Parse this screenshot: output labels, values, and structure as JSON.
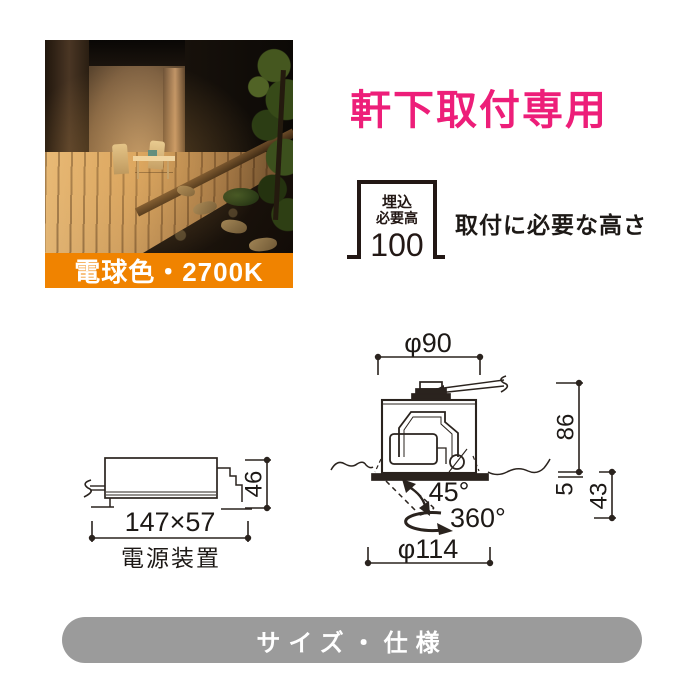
{
  "badge": {
    "label": "電球色・2700K",
    "color": "#f08300"
  },
  "headline": {
    "text": "軒下取付専用",
    "color": "#ed1e79"
  },
  "recess": {
    "line1": "埋込",
    "line2": "必要高",
    "value": "100",
    "caption": "取付に必要な高さ"
  },
  "power_unit": {
    "size": "147×57",
    "height": "46",
    "label": "電源装置"
  },
  "fixture": {
    "top_diameter": "φ90",
    "bottom_diameter": "φ114",
    "embed_height": "86",
    "flange_thickness": "5",
    "protrusion": "43",
    "tilt_angle": "45°",
    "rotation": "360°"
  },
  "footer": {
    "label": "サイズ・仕様",
    "color": "#9b9b9b"
  }
}
